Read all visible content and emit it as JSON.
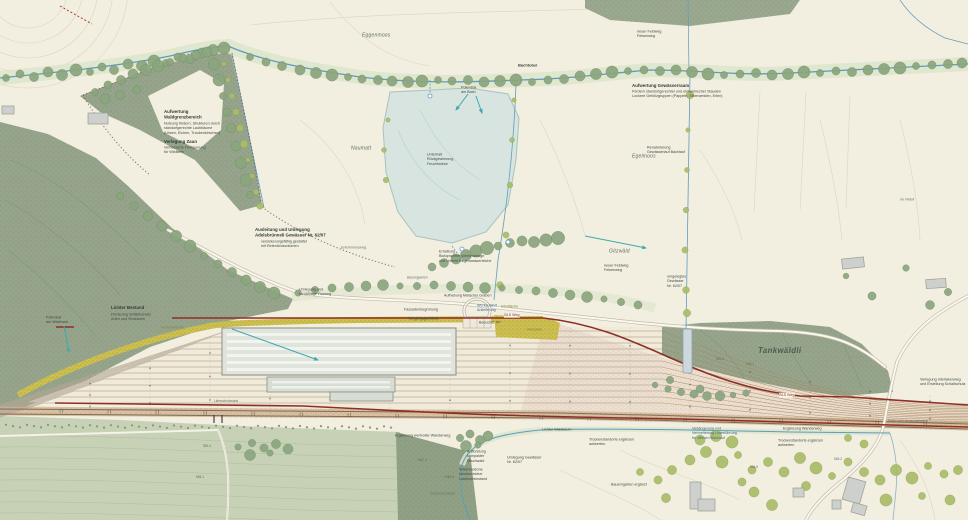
{
  "map": {
    "type": "landscape-site-plan",
    "colors": {
      "paper": "#f2eee0",
      "forest": "#96a48c",
      "meadow": "#c6d1b5",
      "pond": "#d7e4e0",
      "water": "#5f9cbe",
      "wall_red": "#8e2f25",
      "ruderal_yellow": "#cdc050",
      "ballast_tan": "#d9c0a2",
      "arrow_teal": "#3fa9ad"
    },
    "labels": [
      {
        "name": "place-name-eggenmoos",
        "text": "Eggenmoos",
        "x": 362,
        "y": 32,
        "cls": "place"
      },
      {
        "name": "place-name-bachtobel",
        "text": "Bachtobel",
        "x": 518,
        "y": 63,
        "cls": "tinyb"
      },
      {
        "name": "note-potenzial-am-bach",
        "text": "Potenzial\nam Bach",
        "x": 461,
        "y": 85,
        "cls": "tiny"
      },
      {
        "name": "note-neuer-feldweg-nord",
        "text": "neuer Feldweg\nFelsenweg",
        "x": 637,
        "y": 29,
        "cls": "tiny"
      },
      {
        "name": "note-aufwertung-gewaesserraum-titel",
        "text": "Aufwertung Gewässerraum",
        "x": 632,
        "y": 83,
        "cls": "bold"
      },
      {
        "name": "note-aufwertung-gewaesserraum-sub",
        "text": "Fördern standortgerechter und einheimischer Stauden\nLockere Gehölzgruppen (Pappeln, Silberweiden, Erlen)",
        "x": 632,
        "y": 89,
        "cls": "tiny"
      },
      {
        "name": "note-waldgrenze-titel",
        "text": "Aufwertung\nWaldgrenzbereich",
        "x": 164,
        "y": 109,
        "cls": "bold"
      },
      {
        "name": "note-waldgrenze-sub",
        "text": "Nutzung fördern, Strukturen durch\nstandortgerechte Laubbäume\n(Ulmen, Eichen, Traubenkirschen)",
        "x": 164,
        "y": 121,
        "cls": "tiny"
      },
      {
        "name": "note-verlegung-zaun-titel",
        "text": "Verlegung Zaun",
        "x": 164,
        "y": 139,
        "cls": "bold"
      },
      {
        "name": "note-verlegung-zaun-sub",
        "text": "Verbesserte Feldquerung\nfür Wildtiere",
        "x": 164,
        "y": 145,
        "cls": "tiny"
      },
      {
        "name": "place-name-naumatt",
        "text": "Naumatt",
        "x": 351,
        "y": 145,
        "cls": "place"
      },
      {
        "name": "note-feuchtwiese",
        "text": "Unterhalt\nRückgewinnung\nFeuchtwiese",
        "x": 427,
        "y": 152,
        "cls": "tiny"
      },
      {
        "name": "note-renaturierung",
        "text": "Renaturierung\nGewässerlauf Bachlauf",
        "x": 647,
        "y": 145,
        "cls": "tiny"
      },
      {
        "name": "place-name-egelmoos",
        "text": "Egelmoos",
        "x": 632,
        "y": 153,
        "cls": "place"
      },
      {
        "name": "place-name-im-flueli",
        "text": "im Flüeli",
        "x": 900,
        "y": 197,
        "cls": "placexs"
      },
      {
        "name": "place-name-gitzwaeld",
        "text": "Gitzwäld",
        "x": 609,
        "y": 248,
        "cls": "place"
      },
      {
        "name": "note-umgelegtes-gewaesser",
        "text": "umgelegtes\nGewässer\nNr. 62/07",
        "x": 667,
        "y": 274,
        "cls": "tiny"
      },
      {
        "name": "note-neuer-feldweg-ost",
        "text": "neuer Feldweg\nFelsenweg",
        "x": 604,
        "y": 263,
        "cls": "tiny"
      },
      {
        "name": "note-ausleitung-titel",
        "text": "Ausleitung und Umlegung\nAdelsbrünneli Gewässer Nr. 62/07",
        "x": 255,
        "y": 227,
        "cls": "bold"
      },
      {
        "name": "note-ausleitung-sub",
        "text": "versickerungsfähig gestaltet\nmit Retentionsvolumen",
        "x": 261,
        "y": 239,
        "cls": "tiny"
      },
      {
        "name": "place-name-erlenmoosweg",
        "text": "Erlenmoosweg",
        "x": 341,
        "y": 245,
        "cls": "placexs"
      },
      {
        "name": "note-biotopweiher",
        "text": "Erhaltung\nBiotopweiher Weiheranlage\nund Umfeld Regenwasserteiche",
        "x": 439,
        "y": 249,
        "cls": "tiny"
      },
      {
        "name": "place-name-baumgarten",
        "text": "Baumgarten",
        "x": 407,
        "y": 275,
        "cls": "placexs"
      },
      {
        "name": "note-umlegung-flurweg",
        "text": "Umlegung und\nNeuanlage Flurweg",
        "x": 299,
        "y": 287,
        "cls": "tiny"
      },
      {
        "name": "note-aufhebung-muelacher",
        "text": "Aufhebung Mülacher Graben",
        "x": 444,
        "y": 293,
        "cls": "tiny"
      },
      {
        "name": "note-fassadenbegruenung",
        "text": "Fassadenbegrünung",
        "x": 404,
        "y": 307,
        "cls": "tiny"
      },
      {
        "name": "note-eingangsgebaeude",
        "text": "Eingangsgebäude",
        "x": 409,
        "y": 316,
        "cls": "tiny"
      },
      {
        "name": "note-werkzufahrt",
        "text": "Werkzufahrt\nAnlieferung",
        "x": 477,
        "y": 303,
        "cls": "tiny-blue"
      },
      {
        "name": "note-besucher-pp",
        "text": "Besucher PP",
        "x": 479,
        "y": 320,
        "cls": "tiny"
      },
      {
        "name": "note-kiesflaeche",
        "text": "Kiesfläche",
        "x": 501,
        "y": 304,
        "cls": "tiny-olive"
      },
      {
        "name": "note-kiesplatz",
        "text": "Kiesplatz",
        "x": 527,
        "y": 327,
        "cls": "tiny-olive"
      },
      {
        "name": "tag-bls-weg-west",
        "text": "BLS Weg",
        "x": 504,
        "y": 313,
        "cls": "tag-red"
      },
      {
        "name": "tag-bls-weg-ost",
        "text": "BLS Weg",
        "x": 779,
        "y": 393,
        "cls": "tag-red"
      },
      {
        "name": "note-lichter-bestand-titel",
        "text": "Lichter Bestand",
        "x": 111,
        "y": 305,
        "cls": "bold"
      },
      {
        "name": "note-lichter-bestand-sub",
        "text": "Förderung lichtliebender\nArten und Strukturen",
        "x": 111,
        "y": 312,
        "cls": "tiny"
      },
      {
        "name": "note-potenzial-waldrand",
        "text": "Potenzial\nam Waldrand",
        "x": 46,
        "y": 315,
        "cls": "tiny"
      },
      {
        "name": "note-ruderalflaeche",
        "text": "Ruderalfläche",
        "x": 161,
        "y": 325,
        "cls": "tiny-olive"
      },
      {
        "name": "place-name-tankwaeldli",
        "text": "Tankwäldli",
        "x": 758,
        "y": 346,
        "cls": "place-lg"
      },
      {
        "name": "note-verlegung-interlakenweg",
        "text": "Verlegung Interlakenweg\nund Erstellung Schallschutz",
        "x": 920,
        "y": 377,
        "cls": "tiny"
      },
      {
        "name": "note-laermschutzwand",
        "text": "Lärmschutzwand",
        "x": 214,
        "y": 399,
        "cls": "tiny2"
      },
      {
        "name": "note-stuetzmauer",
        "text": "Stütz- und Lärmschutzwand",
        "x": 888,
        "y": 419,
        "cls": "tiny2"
      },
      {
        "name": "note-ergaenzung-wanderweg-west",
        "text": "Ergänzung wertvoller Wanderweg",
        "x": 395,
        "y": 433,
        "cls": "tiny"
      },
      {
        "name": "note-lichter-waldsaum",
        "text": "Lichter Waldsaum",
        "x": 542,
        "y": 427,
        "cls": "tiny"
      },
      {
        "name": "note-trockenstandorte-west",
        "text": "Trockenstandorte ergänzen\naufwerten",
        "x": 589,
        "y": 437,
        "cls": "tiny"
      },
      {
        "name": "note-trockenstandorte-ost",
        "text": "Trockenstandorte ergänzen\naufwerten",
        "x": 778,
        "y": 438,
        "cls": "tiny"
      },
      {
        "name": "note-ergaenzung-wanderweg-ost",
        "text": "Ergänzung Wanderweg",
        "x": 783,
        "y": 426,
        "cls": "tiny"
      },
      {
        "name": "note-unterfuehrung",
        "text": "Verlängerung und\nVerbreiterung Unterführung\nfür offenen Bachlauf",
        "x": 692,
        "y": 426,
        "cls": "tiny-blue"
      },
      {
        "name": "note-aufforstung",
        "text": "Aufforstung\nkompakter\nMischwald",
        "x": 467,
        "y": 449,
        "cls": "tiny"
      },
      {
        "name": "note-waldrandzone",
        "text": "Waldrandzone\nstrukturreicher\nLaubholzbestand",
        "x": 459,
        "y": 467,
        "cls": "tiny"
      },
      {
        "name": "note-umlegung-gewaesser",
        "text": "Umlegung Gewässer\nNr. 62/07",
        "x": 507,
        "y": 455,
        "cls": "tiny"
      },
      {
        "name": "place-name-schachenwald",
        "text": "Schachenwald",
        "x": 430,
        "y": 491,
        "cls": "placexs"
      },
      {
        "name": "note-bauerngarten",
        "text": "Bauerngarten ergänzt",
        "x": 611,
        "y": 482,
        "cls": "tiny"
      },
      {
        "name": "spot-height-1",
        "text": "552.4",
        "x": 203,
        "y": 444,
        "cls": "tiny2"
      },
      {
        "name": "spot-height-2",
        "text": "554.1",
        "x": 196,
        "y": 475,
        "cls": "tiny2"
      },
      {
        "name": "spot-height-3",
        "text": "+547.3",
        "x": 417,
        "y": 458,
        "cls": "tiny2"
      },
      {
        "name": "spot-height-4",
        "text": "+546.8",
        "x": 444,
        "y": 475,
        "cls": "tiny2"
      },
      {
        "name": "spot-height-5",
        "text": "545.6",
        "x": 716,
        "y": 357,
        "cls": "tiny2"
      },
      {
        "name": "spot-height-6",
        "text": "546.1",
        "x": 746,
        "y": 362,
        "cls": "tiny2"
      },
      {
        "name": "spot-height-7",
        "text": "544.6",
        "x": 750,
        "y": 465,
        "cls": "tiny2"
      },
      {
        "name": "spot-height-8",
        "text": "545.2",
        "x": 834,
        "y": 457,
        "cls": "tiny2"
      }
    ]
  }
}
